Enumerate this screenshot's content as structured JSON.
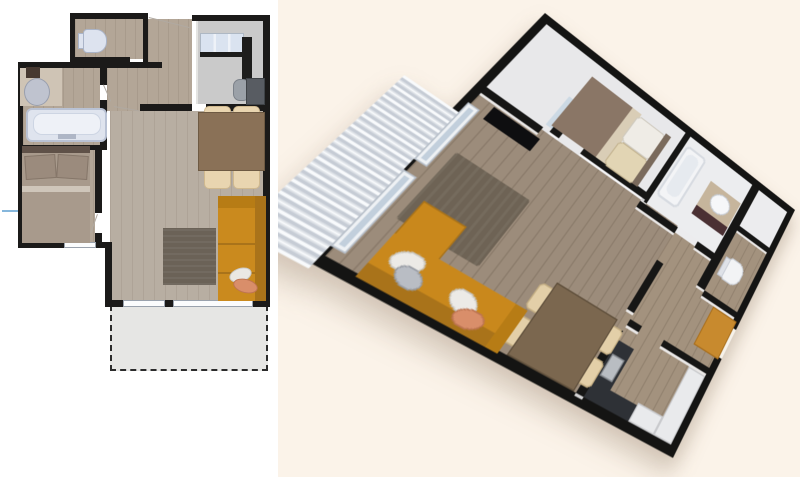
{
  "scene": {
    "title_visible_text": "",
    "views": [
      {
        "id": "plan-2d",
        "style": "top-down 2d floor plan",
        "background": "#ffffff",
        "position": "left"
      },
      {
        "id": "plan-3d",
        "style": "3d perspective dollhouse render, rotated ~38deg",
        "background": "#fbf3e9",
        "position": "right"
      }
    ],
    "rooms": [
      {
        "name": "toilet-room",
        "furniture": [
          "toilet"
        ]
      },
      {
        "name": "bathroom",
        "furniture": [
          "vanity-counter",
          "oval-sink",
          "towel",
          "bathtub"
        ]
      },
      {
        "name": "bedroom",
        "furniture": [
          "double-bed",
          "two-pillows",
          "headboard"
        ]
      },
      {
        "name": "hallway",
        "furniture": [
          "wardrobe-3d-only"
        ]
      },
      {
        "name": "kitchen",
        "furniture": [
          "upper-cabinets",
          "counter",
          "fridge",
          "sink",
          "cooktop"
        ]
      },
      {
        "name": "living-dining",
        "furniture": [
          "dining-table",
          "four-chairs",
          "orange-sofa",
          "sofa-pillows",
          "rug",
          "tv-3d-only"
        ]
      },
      {
        "name": "terrace",
        "furniture": [
          "dashed-outline-2d",
          "slatted-railing-3d"
        ]
      }
    ],
    "counts": {
      "dining_chairs": 4,
      "sofa_pillows_2d": 2,
      "bed_pillows": 2,
      "windows_living": 2
    }
  },
  "palette": {
    "left_bg": "#ffffff",
    "right_bg": "#fbf3e9",
    "wall_black": "#1b1a19",
    "wood_floor": "#b3a697",
    "living_floor": "#b8aea2",
    "kitchen_floor_2d": "#cacaca",
    "sofa_orange": "#ca8a1e",
    "sofa_back_orange": "#a9731a",
    "table_brown": "#8a7157",
    "chair_beige": "#e9d5b0",
    "rug_gray": "#6b6257",
    "bed_blanket": "#a89a8c",
    "bed_pillow": "#9b8b7d",
    "headboard": "#5f5148",
    "tub_fill": "#dfe4ee",
    "fixture_white": "#dde3ef",
    "counter_beige": "#cfc4b5",
    "terrace_gray": "#e6e6e4",
    "glass_blue": "#dae3f0",
    "pillow_salmon": "#d98e6a",
    "wood_floor_3d": "#9c8c7b",
    "vanity_cabinet_3d": "#4a3033",
    "wardrobe_orange_3d": "#c88a2e",
    "dash_blue": "#86b7dc"
  }
}
